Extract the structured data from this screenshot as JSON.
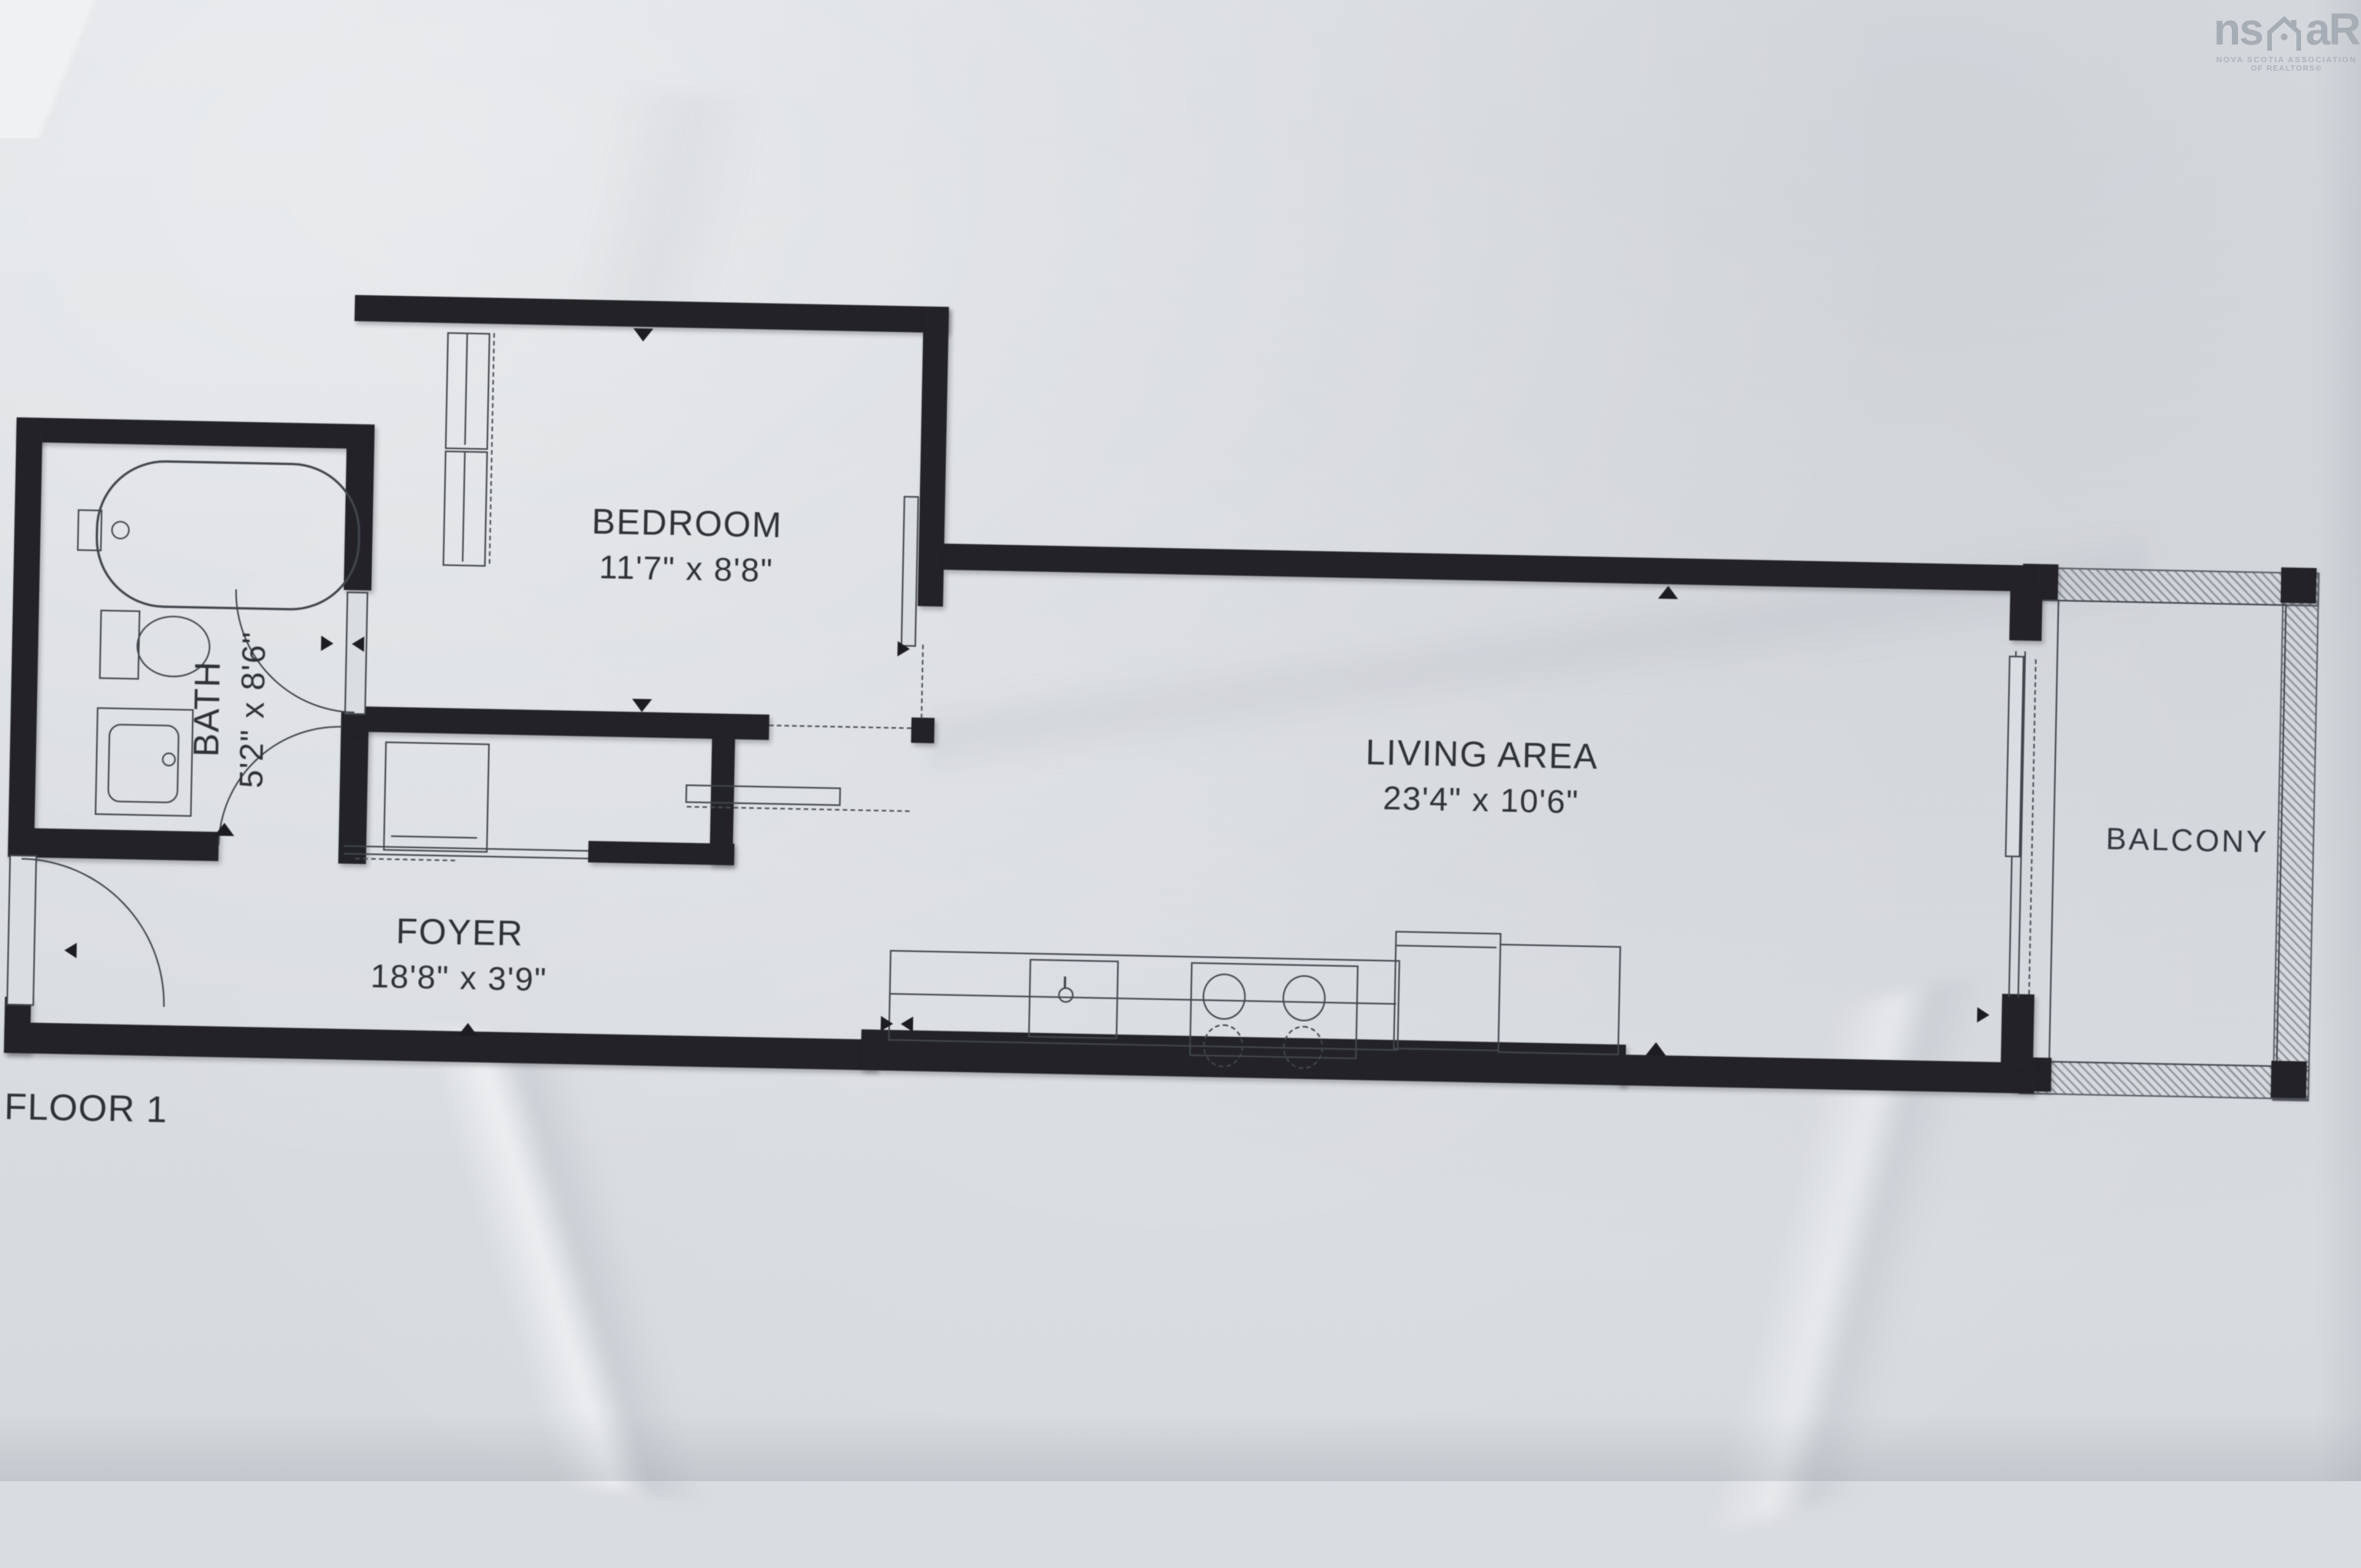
{
  "logo": {
    "prefix": "ns",
    "suffix": "aR",
    "icon": "house-icon",
    "caption_line1": "NOVA SCOTIA ASSOCIATION",
    "caption_line2": "OF REALTORS®"
  },
  "floor_label": "FLOOR 1",
  "rooms": {
    "bedroom": {
      "name": "BEDROOM",
      "dims": "11'7\" x 8'8\""
    },
    "bath": {
      "name": "BATH",
      "dims": "5'2\" x 8'6\""
    },
    "living": {
      "name": "LIVING AREA",
      "dims": "23'4\" x 10'6\""
    },
    "foyer": {
      "name": "FOYER",
      "dims": "18'8\" x 3'9\""
    },
    "balcony": {
      "name": "BALCONY"
    }
  },
  "fixtures": [
    "bathtub",
    "toilet",
    "vanity-sink",
    "entry-door",
    "bath-door",
    "closet",
    "sliding-door",
    "kitchen-counter",
    "kitchen-sink",
    "cooktop",
    "refrigerator",
    "balcony-railing"
  ],
  "colors": {
    "paper": "#dadde1",
    "wall": "#232327",
    "line": "#41464c",
    "text": "#2e3237",
    "logo": "#a6adb5"
  }
}
